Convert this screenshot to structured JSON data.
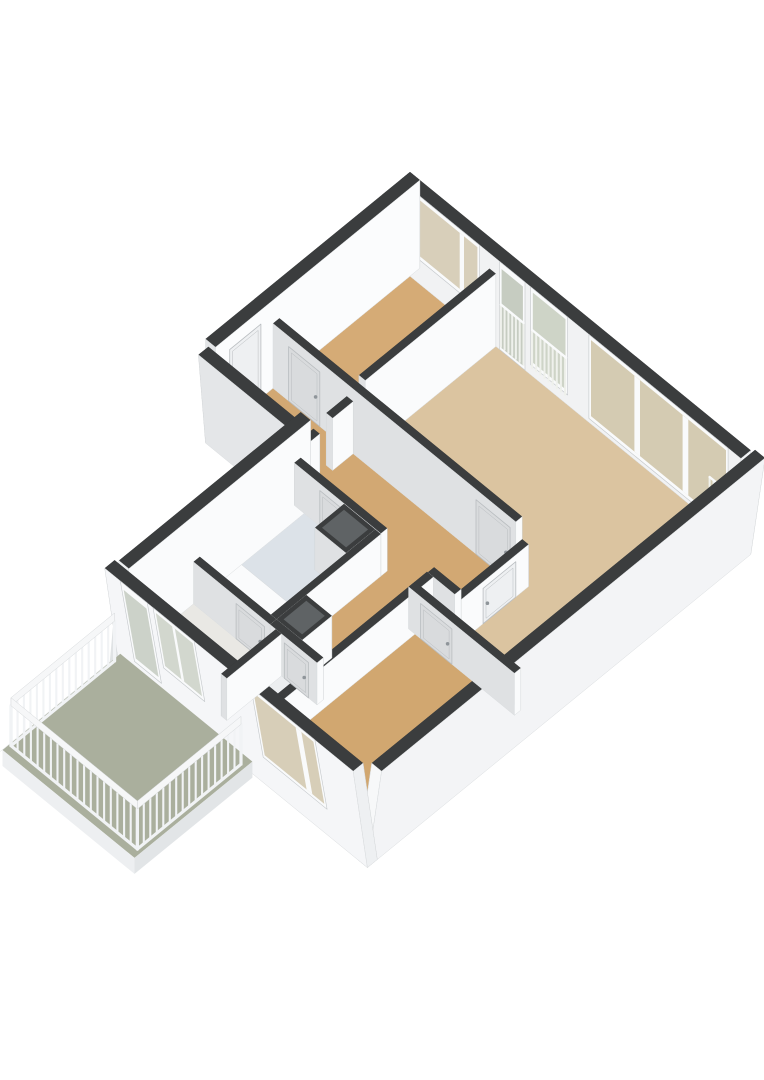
{
  "app": {
    "type": "3d-floorplan-rendering",
    "background": "#ffffff"
  },
  "floorplan": {
    "projection": {
      "ox": 410,
      "oy": 260,
      "ax": 0.71,
      "ay": 0.58,
      "wall_far_h": 88,
      "wall_near_h": 92,
      "int_h_min": 42,
      "int_h_slope": 0.11,
      "skirt": 16
    },
    "palette": {
      "wall_top": "#3b3d3e",
      "wall_dark_side": "#333536",
      "int_face_y": "#dfe1e3",
      "int_face_x": "#fafbfc",
      "face_stroke": "#d9dcde",
      "frame": "#f9fafb",
      "frame_stroke": "#c3c7ca",
      "door_leaf_y": "#d9dbdd",
      "door_leaf_x": "#eef0f2",
      "door_stroke": "#b9bdc0",
      "handle": "#8f959a",
      "shaft_inner": "#5f6365",
      "ext_face_side": "#e0e3e5",
      "fixture_top": "#fafbfc",
      "fixture_y": "#eef1f3",
      "fixture_x": "#e4e7e9",
      "fixture_stroke": "#d5d8da",
      "rail_bar": "#f1f3f5",
      "rail_top": "#f6f7f8",
      "rail_stroke": "#d5d8da",
      "window_bar": "#eff1ec"
    },
    "floors": [
      {
        "name": "floor-bedroom-1",
        "color": "#d5ab76",
        "pts": [
          [
            14,
            14
          ],
          [
            126,
            14
          ],
          [
            126,
            198
          ],
          [
            14,
            198
          ]
        ]
      },
      {
        "name": "floor-living-room",
        "color": "#dbc4a0",
        "pts": [
          [
            135,
            14
          ],
          [
            466,
            14
          ],
          [
            466,
            310
          ],
          [
            365,
            310
          ],
          [
            365,
            198
          ],
          [
            135,
            198
          ]
        ]
      },
      {
        "name": "floor-hallway",
        "color": "#d2a873",
        "pts": [
          [
            14,
            207
          ],
          [
            356,
            207
          ],
          [
            356,
            284
          ],
          [
            318,
            284
          ],
          [
            318,
            440
          ],
          [
            252,
            440
          ],
          [
            252,
            284
          ],
          [
            14,
            284
          ]
        ]
      },
      {
        "name": "floor-bathroom",
        "color": "#dce2e8",
        "pts": [
          [
            144,
            293
          ],
          [
            244,
            293
          ],
          [
            244,
            440
          ],
          [
            144,
            440
          ]
        ]
      },
      {
        "name": "floor-toilet",
        "color": "#eceef0",
        "pts": [
          [
            268,
            449
          ],
          [
            318,
            449
          ],
          [
            318,
            526
          ],
          [
            268,
            526
          ]
        ]
      },
      {
        "name": "floor-kitchen",
        "color": "#e9e8e4",
        "pts": [
          [
            144,
            449
          ],
          [
            260,
            449
          ],
          [
            260,
            526
          ],
          [
            144,
            526
          ]
        ]
      },
      {
        "name": "floor-bedroom-2",
        "color": "#d1a770",
        "pts": [
          [
            326,
            319
          ],
          [
            466,
            319
          ],
          [
            466,
            526
          ],
          [
            326,
            526
          ]
        ]
      }
    ],
    "fixtures": [
      {
        "name": "bathtub",
        "box": [
          148,
          402,
          240,
          436
        ],
        "h": 24
      },
      {
        "name": "washbasin",
        "box": [
          206,
          297,
          240,
          327
        ],
        "h": 22
      },
      {
        "name": "toilet-bowl",
        "box": [
          280,
          494,
          302,
          516
        ],
        "h": 16
      }
    ],
    "walls": [
      {
        "name": "exterior-wall-top",
        "id": "E1",
        "box": [
          0,
          0,
          480,
          14
        ],
        "kind": "ext-far",
        "face_y": "#f1f2f3",
        "face_x": "#f3f4f6"
      },
      {
        "name": "exterior-wall-left-upper",
        "id": "E6",
        "box": [
          0,
          0,
          14,
          288
        ],
        "kind": "ext-far",
        "face_x": "#fbfcfd",
        "face_y": "#e3e5e7"
      },
      {
        "name": "exterior-wall-right",
        "id": "E2",
        "box": [
          466,
          0,
          480,
          540
        ],
        "kind": "ext-near",
        "skirt": true,
        "shear": 20,
        "shear_dir": "x",
        "face_x": "#f3f4f6",
        "face_y": "#f7f8f9"
      },
      {
        "name": "exterior-wall-bottom",
        "id": "E3",
        "box": [
          130,
          526,
          480,
          540
        ],
        "kind": "ext-near",
        "skirt": true,
        "shear": 20,
        "shear_dir": "y",
        "face_y": "#f5f6f8",
        "face_x": "#eef0f2"
      },
      {
        "name": "exterior-wall-left-lower",
        "id": "E4",
        "box": [
          130,
          284,
          144,
          540
        ],
        "kind": "ext-near",
        "h": 88,
        "fake_left": true,
        "face_x": "#fafbfc",
        "face_y": "#f0f2f4"
      },
      {
        "name": "exterior-wall-entry",
        "id": "E5",
        "box": [
          0,
          274,
          130,
          288
        ],
        "kind": "ext-near",
        "h": 78,
        "skirt": true,
        "shear": 10,
        "shear_dir": "y",
        "face_y": "#e4e6e8",
        "face_x": "#eceef0"
      },
      {
        "name": "partition-bedroom1-living",
        "id": "W1",
        "box": [
          126,
          14,
          135,
          198
        ],
        "kind": "int"
      },
      {
        "name": "partition-hall-north",
        "id": "W2",
        "box": [
          14,
          198,
          356,
          207
        ],
        "kind": "int"
      },
      {
        "name": "partition-hall-living",
        "id": "W3",
        "box": [
          356,
          198,
          365,
          319
        ],
        "kind": "int"
      },
      {
        "name": "partition-living-bedroom2",
        "id": "W4",
        "box": [
          317,
          310,
          466,
          319
        ],
        "kind": "int"
      },
      {
        "name": "partition-hall-bathroom",
        "id": "W5",
        "box": [
          130,
          284,
          252,
          293
        ],
        "kind": "int"
      },
      {
        "name": "partition-hall-south-right",
        "id": "W6",
        "box": [
          318,
          284,
          356,
          293
        ],
        "kind": "int"
      },
      {
        "name": "partition-bathroom-corridor",
        "id": "W7",
        "box": [
          244,
          293,
          252,
          440
        ],
        "kind": "int"
      },
      {
        "name": "partition-corridor-bedroom2",
        "id": "W8",
        "box": [
          317,
          293,
          326,
          526
        ],
        "kind": "int"
      },
      {
        "name": "partition-bathroom-kitchen",
        "id": "W9",
        "box": [
          144,
          440,
          252,
          449
        ],
        "kind": "int"
      },
      {
        "name": "partition-corridor-toilet",
        "id": "W10",
        "box": [
          252,
          440,
          318,
          449
        ],
        "kind": "int"
      },
      {
        "name": "partition-kitchen-toilet",
        "id": "W11",
        "box": [
          260,
          449,
          268,
          526
        ],
        "kind": "int"
      },
      {
        "name": "partition-entry-hall-a",
        "id": "W12a",
        "box": [
          118,
          207,
          127,
          236
        ],
        "kind": "int"
      },
      {
        "name": "partition-entry-hall-b",
        "id": "W12b",
        "box": [
          118,
          254,
          127,
          284
        ],
        "kind": "int"
      },
      {
        "name": "duct-shaft-1",
        "id": "S1",
        "box": [
          200,
          293,
          244,
          334
        ],
        "kind": "shaft"
      },
      {
        "name": "duct-shaft-2",
        "id": "S2",
        "box": [
          252,
          398,
          288,
          440
        ],
        "kind": "shaft"
      }
    ],
    "windows": [
      {
        "name": "bedroom1-window",
        "wall": "E1",
        "face": "y",
        "t": [
          22,
          112
        ],
        "frame": [
          24,
          88
        ],
        "glass": [
          28,
          84
        ],
        "mullions": [
          [
            84,
            90
          ]
        ],
        "color": "#d8cfba"
      },
      {
        "name": "living-french-door",
        "wall": "E1",
        "face": "y",
        "t": [
          140,
          176
        ],
        "frame": [
          0,
          88
        ],
        "glass": [
          3,
          82
        ],
        "color": "#c6ccc1",
        "bars": {
          "t0": 142,
          "t1": 174,
          "step": 5.3,
          "z0": 4,
          "z1": 46
        }
      },
      {
        "name": "living-window-1",
        "wall": "E1",
        "face": "y",
        "t": [
          184,
          236
        ],
        "frame": [
          10,
          88
        ],
        "glass": [
          14,
          84
        ],
        "color": "#ced4c7",
        "bars": {
          "t0": 186,
          "t1": 234,
          "step": 5.8,
          "z0": 8,
          "z1": 46
        }
      },
      {
        "name": "living-window-wall",
        "wall": "E1",
        "face": "y",
        "t": [
          266,
          462
        ],
        "frame": [
          4,
          88
        ],
        "glass": [
          8,
          84
        ],
        "mullions": [
          [
            330,
            338
          ],
          [
            398,
            406
          ]
        ],
        "color": "#d4cbb2",
        "bars": {
          "t0": 436,
          "t1": 458,
          "step": 5.5,
          "z0": 8,
          "z1": 44
        }
      },
      {
        "name": "kitchen-balcony-door",
        "wall": "E3",
        "face": "y",
        "t": [
          152,
          190
        ],
        "frame": [
          0,
          88
        ],
        "glass": [
          5,
          80
        ],
        "color": "#ccd2c9"
      },
      {
        "name": "kitchen-window",
        "wall": "E3",
        "face": "y",
        "t": [
          198,
          256
        ],
        "frame": [
          22,
          88
        ],
        "glass": [
          26,
          84
        ],
        "mullions": [
          [
            224,
            228
          ]
        ],
        "color": "#d2d7ce"
      },
      {
        "name": "bedroom2-window",
        "wall": "E3",
        "face": "y",
        "t": [
          336,
          426
        ],
        "frame": [
          12,
          88
        ],
        "glass": [
          16,
          84
        ],
        "mullions": [
          [
            398,
            406
          ]
        ],
        "color": "#d7ceb8"
      }
    ],
    "doors": [
      {
        "name": "front-door",
        "wall": "E6",
        "face": "x",
        "t": [
          224,
          268
        ]
      },
      {
        "name": "bedroom1-door",
        "wall": "W2",
        "face": "y",
        "t": [
          36,
          80
        ]
      },
      {
        "name": "living-door-a",
        "wall": "W2",
        "face": "y",
        "t": [
          300,
          348
        ]
      },
      {
        "name": "living-door-b",
        "wall": "W3",
        "face": "x",
        "t": [
          216,
          262
        ]
      },
      {
        "name": "bathroom-door",
        "wall": "W5",
        "face": "y",
        "t": [
          166,
          210
        ]
      },
      {
        "name": "kitchen-door",
        "wall": "W9",
        "face": "y",
        "t": [
          204,
          244
        ]
      },
      {
        "name": "toilet-door",
        "wall": "W10",
        "face": "y",
        "t": [
          272,
          306
        ]
      },
      {
        "name": "bedroom2-door",
        "wall": "W4",
        "face": "y",
        "t": [
          334,
          378
        ]
      }
    ],
    "balcony": {
      "slab": {
        "x0": 132,
        "y0": 540,
        "x1": 318,
        "y1": 706,
        "top_z": -4,
        "bot_z": -20,
        "floor": "#aaaf9d",
        "fascia_y": "#edeff1",
        "fascia_x": "#e2e5e7",
        "fascia_left": "#dfe2e4"
      },
      "railing": {
        "step": 9,
        "bar_z": [
          -2,
          38
        ],
        "top_z": [
          38,
          46
        ],
        "base_z": [
          -4,
          0
        ],
        "runs": [
          [
            136,
            552,
            136,
            698
          ],
          [
            136,
            698,
            314,
            698
          ],
          [
            314,
            698,
            314,
            552
          ]
        ]
      }
    }
  }
}
